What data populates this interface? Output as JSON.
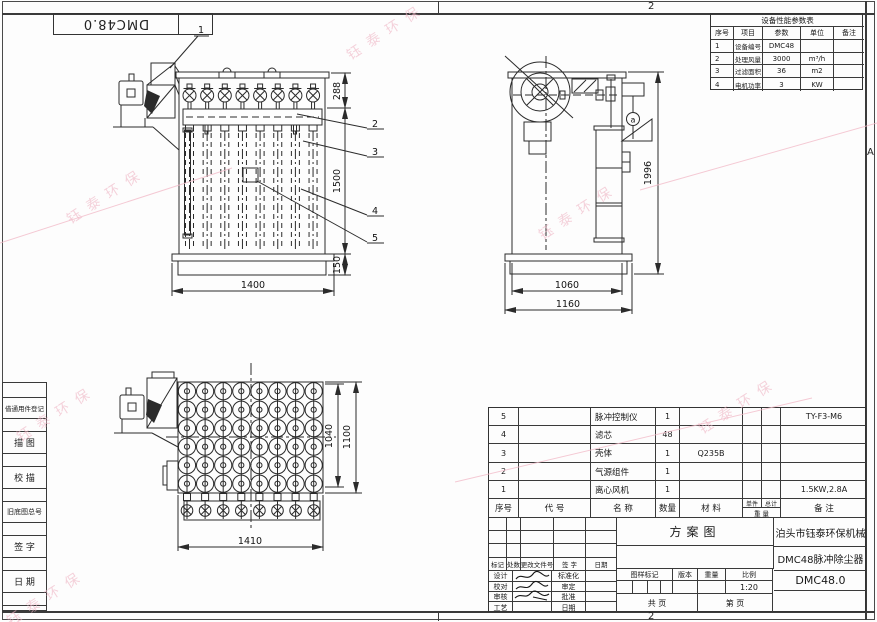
{
  "frame": {
    "zone_top": "2",
    "zone_bottom": "2",
    "zone_right": "A"
  },
  "corner_code": "DMC48.0",
  "watermark": {
    "text": "钰泰环保",
    "color": "#efb4c4"
  },
  "margin_table": {
    "labels": [
      "借通用件登记",
      "描 图",
      "校 描",
      "旧底图总号",
      "签 字",
      "日 期"
    ]
  },
  "param_table": {
    "title": "设备性能参数表",
    "headers": [
      "序号",
      "项目",
      "参数",
      "单位",
      "备注"
    ],
    "rows": [
      [
        "1",
        "设备编号",
        "DMC48",
        "",
        ""
      ],
      [
        "2",
        "处理风量",
        "3000",
        "m³/h",
        ""
      ],
      [
        "3",
        "过滤面积",
        "36",
        "m2",
        ""
      ],
      [
        "4",
        "电机功率",
        "3",
        "KW",
        ""
      ]
    ]
  },
  "front_view": {
    "balloon_1": "1",
    "balloon_2": "2",
    "balloon_3": "3",
    "balloon_4": "4",
    "balloon_5": "5",
    "dim_top": "288",
    "dim_body": "1500",
    "dim_base": "150",
    "dim_width": "1400"
  },
  "side_view": {
    "balloon_a": "a",
    "dim_height": "1996",
    "dim_inner_width": "1060",
    "dim_outer_width": "1160"
  },
  "plan_view": {
    "dim_inner": "1040",
    "dim_outer": "1100",
    "dim_width": "1410"
  },
  "bom": {
    "headers": {
      "no": "序号",
      "code": "代  号",
      "name": "名  称",
      "qty": "数量",
      "material": "材  料",
      "unit": "单件",
      "total": "总计",
      "weight": "重 量",
      "remark": "备  注"
    },
    "rows": [
      {
        "no": "5",
        "code": "",
        "name": "脉冲控制仪",
        "qty": "1",
        "material": "",
        "unit": "",
        "total": "",
        "remark": "TY-F3-M6"
      },
      {
        "no": "4",
        "code": "",
        "name": "滤芯",
        "qty": "48",
        "material": "",
        "unit": "",
        "total": "",
        "remark": ""
      },
      {
        "no": "3",
        "code": "",
        "name": "壳体",
        "qty": "1",
        "material": "Q235B",
        "unit": "",
        "total": "",
        "remark": ""
      },
      {
        "no": "2",
        "code": "",
        "name": "气源组件",
        "qty": "1",
        "material": "",
        "unit": "",
        "total": "",
        "remark": ""
      },
      {
        "no": "1",
        "code": "",
        "name": "离心风机",
        "qty": "1",
        "material": "",
        "unit": "",
        "total": "",
        "remark": "1.5KW,2.8A"
      }
    ]
  },
  "title_block": {
    "rev_headers": [
      "标记",
      "处数",
      "更改文件号",
      "签 字",
      "日期"
    ],
    "roles_left": [
      "设计",
      "校对",
      "审核",
      "工艺"
    ],
    "roles_right": [
      "标准化",
      "审定",
      "批准",
      "日期"
    ],
    "drawing_type": "方案图",
    "company": "泊头市钰泰环保机械",
    "product": "DMC48脉冲除尘器",
    "drawing_no": "DMC48.0",
    "mark_headers": [
      "图样标记",
      "版本",
      "重量",
      "比例"
    ],
    "scale": "1:20",
    "pages_total": "共   页",
    "pages_no": "第   页"
  }
}
